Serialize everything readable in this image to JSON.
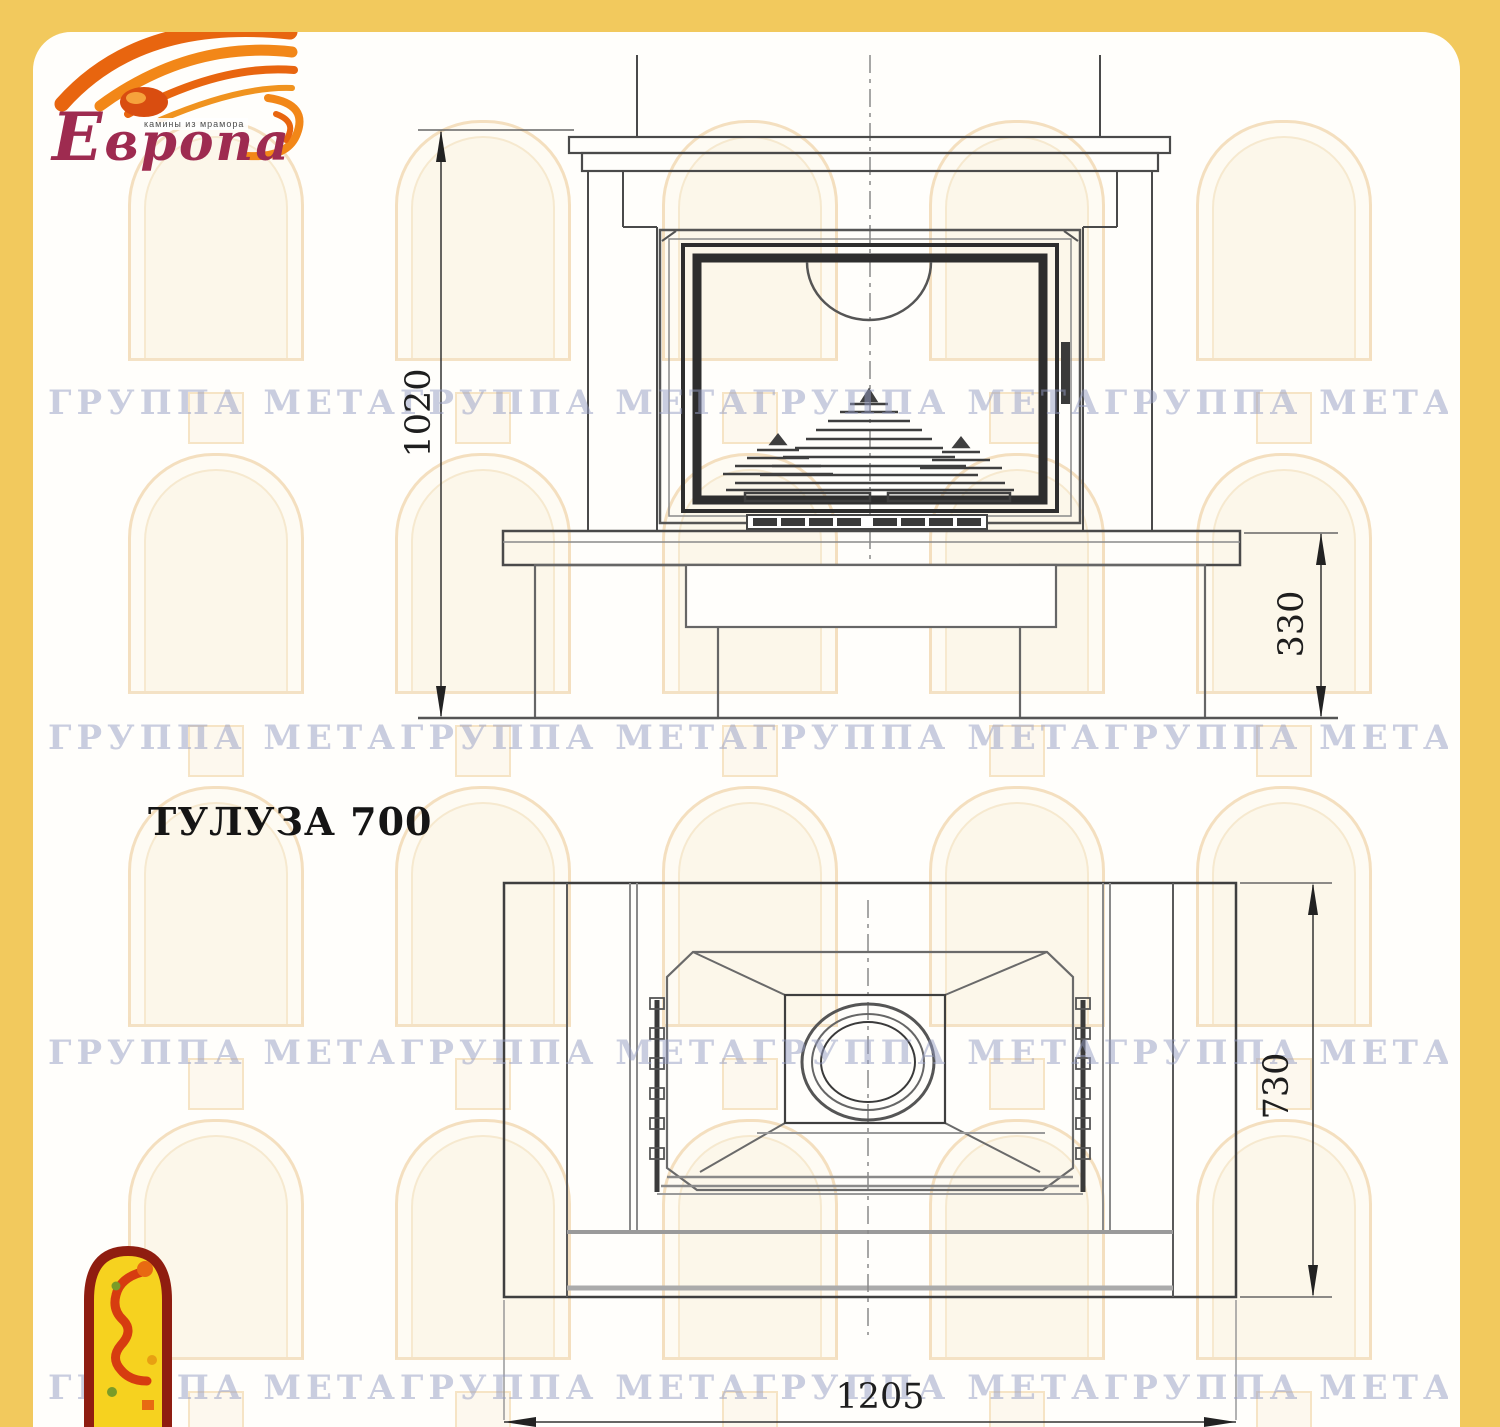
{
  "brand": {
    "name": "Европа",
    "tagline": "камины из мрамора",
    "brand_color": "#9e2b50",
    "flame_color": "#e8650f"
  },
  "title": "ТУЛУЗА 700",
  "watermark": {
    "text": "ГРУППА МЕТАГРУППА МЕТАГРУППА МЕТАГРУППА МЕТА",
    "color": "#949bc4"
  },
  "dimensions": {
    "overall_height": "1020",
    "base_height": "330",
    "depth": "730",
    "width": "1205"
  },
  "colors": {
    "frame_yellow": "#f2c95d",
    "paper": "#fffefb",
    "line_dark": "#3c3c3c",
    "line_gray": "#8a8a8a",
    "emblem_red": "#8f1d10",
    "emblem_yellow": "#f6d21f"
  }
}
